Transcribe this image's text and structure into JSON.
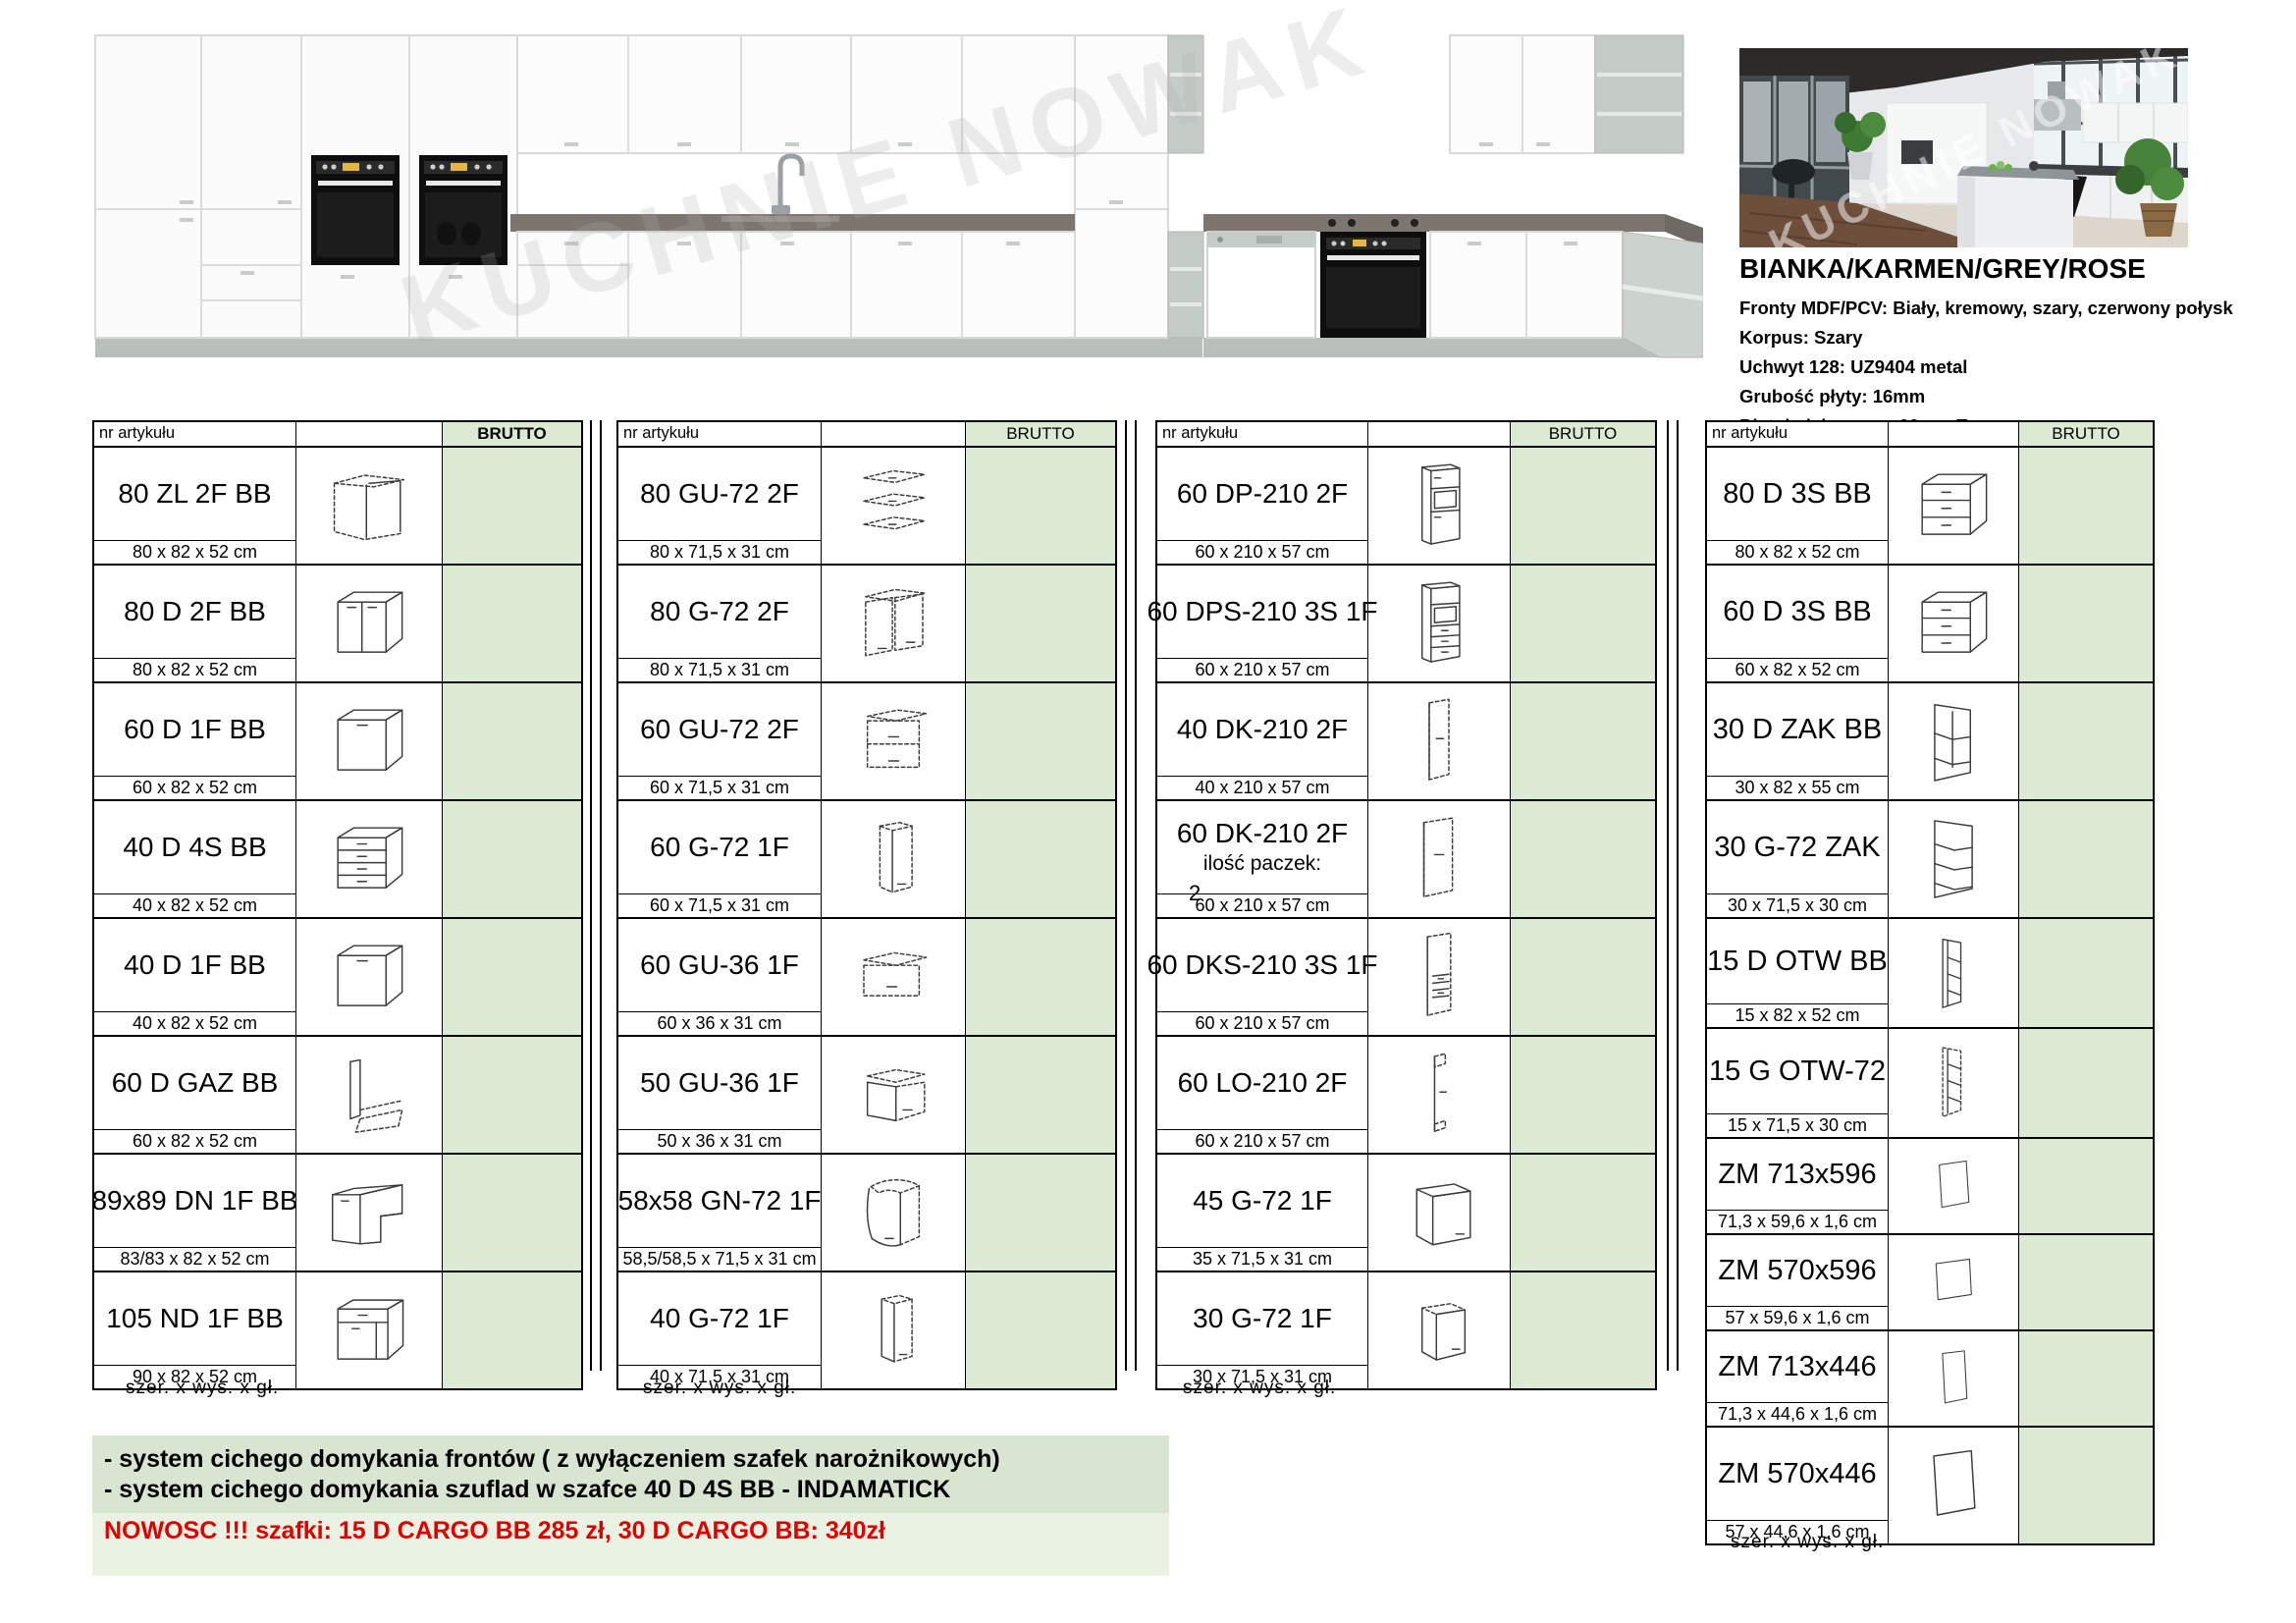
{
  "elevation": {
    "watermark": "KUCHNIE NOWAK"
  },
  "photo": {
    "watermark": "KUCHNIE NOWAK"
  },
  "product_info": {
    "title": "BIANKA/KARMEN/GREY/ROSE",
    "lines": [
      "Fronty MDF/PCV: Biały, kremowy, szary, czerwony połysk",
      "Korpus: Szary",
      "Uchwyt 128: UZ9404 metal",
      "Grubość płyty: 16mm",
      "Blat dedykowany: 28mm Trawertyn szary"
    ]
  },
  "tables": [
    {
      "header": {
        "article_label": "nr artykułu",
        "price_label": "BRUTTO"
      },
      "footer": "szer.  x  wys.  x  gł.",
      "rows": [
        {
          "name": "80 ZL 2F BB",
          "dims": "80 x 82 x 52 cm",
          "icon": "sink-base-dashed"
        },
        {
          "name": "80 D 2F BB",
          "dims": "80 x 82 x 52 cm",
          "icon": "base-2door"
        },
        {
          "name": "60 D 1F BB",
          "dims": "60 x 82 x 52 cm",
          "icon": "base-1door"
        },
        {
          "name": "40 D 4S BB",
          "dims": "40 x 82 x 52 cm",
          "icon": "base-4drawer"
        },
        {
          "name": "40 D 1F BB",
          "dims": "40 x 82 x 52 cm",
          "icon": "base-1door"
        },
        {
          "name": "60 D GAZ BB",
          "dims": "60 x 82 x 52 cm",
          "icon": "panel-dashed"
        },
        {
          "name": "89x89 DN 1F BB",
          "dims": "83/83 x 82 x 52 cm",
          "icon": "corner-base"
        },
        {
          "name": "105 ND 1F BB",
          "dims": "90 x 82 x 52 cm",
          "icon": "base-door-drawer"
        }
      ]
    },
    {
      "header": {
        "article_label": "nr artykułu",
        "price_label": "BRUTTO"
      },
      "footer": "szer.  x  wys.  x  gł.",
      "rows": [
        {
          "name": "80 GU-72 2F",
          "dims": "80 x 71,5 x 31 cm",
          "icon": "wall-exploded"
        },
        {
          "name": "80 G-72 2F",
          "dims": "80 x 71,5 x 31 cm",
          "icon": "wall-2door-dashed"
        },
        {
          "name": "60 GU-72 2F",
          "dims": "60 x 71,5 x 31 cm",
          "icon": "wall-2flap"
        },
        {
          "name": "60 G-72 1F",
          "dims": "60 x 71,5 x 31 cm",
          "icon": "wall-1door-tall"
        },
        {
          "name": "60 GU-36 1F",
          "dims": "60 x 36 x 31 cm",
          "icon": "wall-flap-low"
        },
        {
          "name": "50 GU-36 1F",
          "dims": "50 x 36 x 31 cm",
          "icon": "wall-flap-low2"
        },
        {
          "name": "58x58 GN-72 1F",
          "dims": "58,5/58,5 x 71,5 x 31 cm",
          "icon": "corner-wall"
        },
        {
          "name": "40 G-72 1F",
          "dims": "40 x 71,5 x 31 cm",
          "icon": "wall-1door-narrow"
        }
      ]
    },
    {
      "header": {
        "article_label": "nr artykułu",
        "price_label": "BRUTTO"
      },
      "footer": "szer.  x  wys.  x  gł.",
      "rows": [
        {
          "name": "60 DP-210 2F",
          "dims": "60 x 210 x 57 cm",
          "icon": "tall-oven"
        },
        {
          "name": "60 DPS-210 3S 1F",
          "dims": "60 x 210 x 57 cm",
          "icon": "tall-oven-drawers"
        },
        {
          "name": "40 DK-210 2F",
          "dims": "40 x 210 x 57 cm",
          "icon": "tall-dashed-narrow"
        },
        {
          "name": "60 DK-210 2F",
          "dims": "60 x 210 x 57 cm",
          "icon": "tall-dashed-wide",
          "note": "ilość paczek:",
          "note2": "2"
        },
        {
          "name": "60 DKS-210 3S 1F",
          "dims": "60 x 210 x 57 cm",
          "icon": "tall-dashed-drawers"
        },
        {
          "name": "60 LO-210 2F",
          "dims": "60 x 210 x 57 cm",
          "icon": "tall-dashed-thin"
        },
        {
          "name": "45 G-72 1F",
          "dims": "35 x 71,5 x 31 cm",
          "icon": "wall-1door-solid"
        },
        {
          "name": "30 G-72 1F",
          "dims": "30 x 71,5 x 31 cm",
          "icon": "wall-1door-small"
        }
      ]
    },
    {
      "header": {
        "article_label": "nr artykułu",
        "price_label": "BRUTTO"
      },
      "footer": "szer.  x  wys.  x  gł.",
      "rows": [
        {
          "name": "80 D 3S BB",
          "dims": "80 x 82 x 52 cm",
          "icon": "base-3drawer"
        },
        {
          "name": "60 D 3S BB",
          "dims": "60 x 82 x 52 cm",
          "icon": "base-3drawer"
        },
        {
          "name": "30 D ZAK BB",
          "dims": "30 x 82 x 55 cm",
          "icon": "open-corner-base"
        },
        {
          "name": "30 G-72 ZAK",
          "dims": "30 x 71,5 x 30 cm",
          "icon": "open-corner-wall"
        },
        {
          "name": "15 D OTW BB",
          "dims": "15 x 82 x 52 cm",
          "icon": "open-narrow-base"
        },
        {
          "name": "15 G OTW-72",
          "dims": "15 x 71,5 x 30 cm",
          "icon": "open-narrow-wall"
        },
        {
          "name": "ZM 713x596",
          "dims": "71,3 x 59,6 x 1,6 cm",
          "icon": "panel-front"
        },
        {
          "name": "ZM 570x596",
          "dims": "57 x 59,6 x 1,6 cm",
          "icon": "panel-front-wide"
        },
        {
          "name": "ZM 713x446",
          "dims": "71,3 x 44,6 x 1,6 cm",
          "icon": "panel-front-tall"
        },
        {
          "name": "ZM 570x446",
          "dims": "57 x 44,6 x 1,6 cm",
          "icon": "panel-front"
        }
      ]
    }
  ],
  "notes": {
    "line1": "- system cichego domykania frontów ( z wyłączeniem szafek narożnikowych)",
    "line2": "- system cichego domykania szuflad w szafce 40 D 4S BB - INDAMATICK",
    "line3": "NOWOSC !!! szafki: 15 D CARGO BB 285 zł,  30 D CARGO BB: 340zł"
  },
  "colors": {
    "brutto_green": "#dcead3",
    "note_band_dark": "#d8e5d1",
    "note_band_light": "#eaf2e4",
    "note_red": "#e00000"
  }
}
